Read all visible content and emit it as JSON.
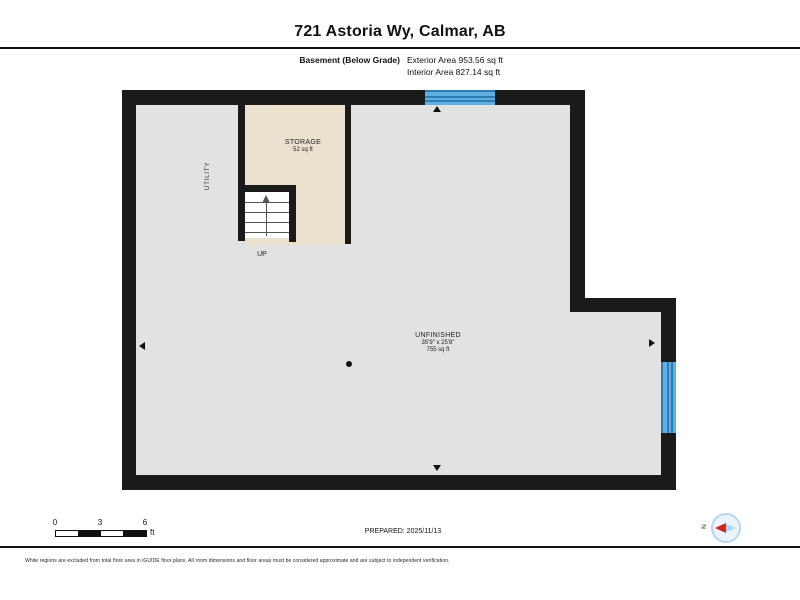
{
  "header": {
    "title": "721 Astoria Wy, Calmar, AB",
    "floor_label": "Basement (Below Grade)",
    "exterior_area": "Exterior Area 953.56 sq ft",
    "interior_area": "Interior Area 827.14 sq ft"
  },
  "rooms": {
    "storage": {
      "name": "STORAGE",
      "area": "52 sq ft"
    },
    "utility": {
      "name": "UTILITY"
    },
    "unfinished": {
      "name": "UNFINISHED",
      "dimensions": "35'9\" x 25'8\"",
      "area": "755 sq ft"
    },
    "stairs": {
      "direction": "UP"
    }
  },
  "scale_bar": {
    "labels": [
      "0",
      "3",
      "6"
    ],
    "unit": "ft"
  },
  "compass": {
    "north_label": "N"
  },
  "footer": {
    "prepared": "PREPARED: 2025/11/13",
    "disclaimer": "White regions are excluded from total floor area in iGUIDE floor plans. All room dimensions and floor areas must be considered approximate and are subject to independent verification."
  },
  "colors": {
    "wall": "#1a1a1a",
    "floor": "#e2e2e2",
    "storage_floor": "#eae1ce",
    "window_fill": "#5fb0e0",
    "window_line": "#2d7cb4",
    "compass_red": "#d1261c",
    "compass_blue": "#b5d8f2"
  }
}
